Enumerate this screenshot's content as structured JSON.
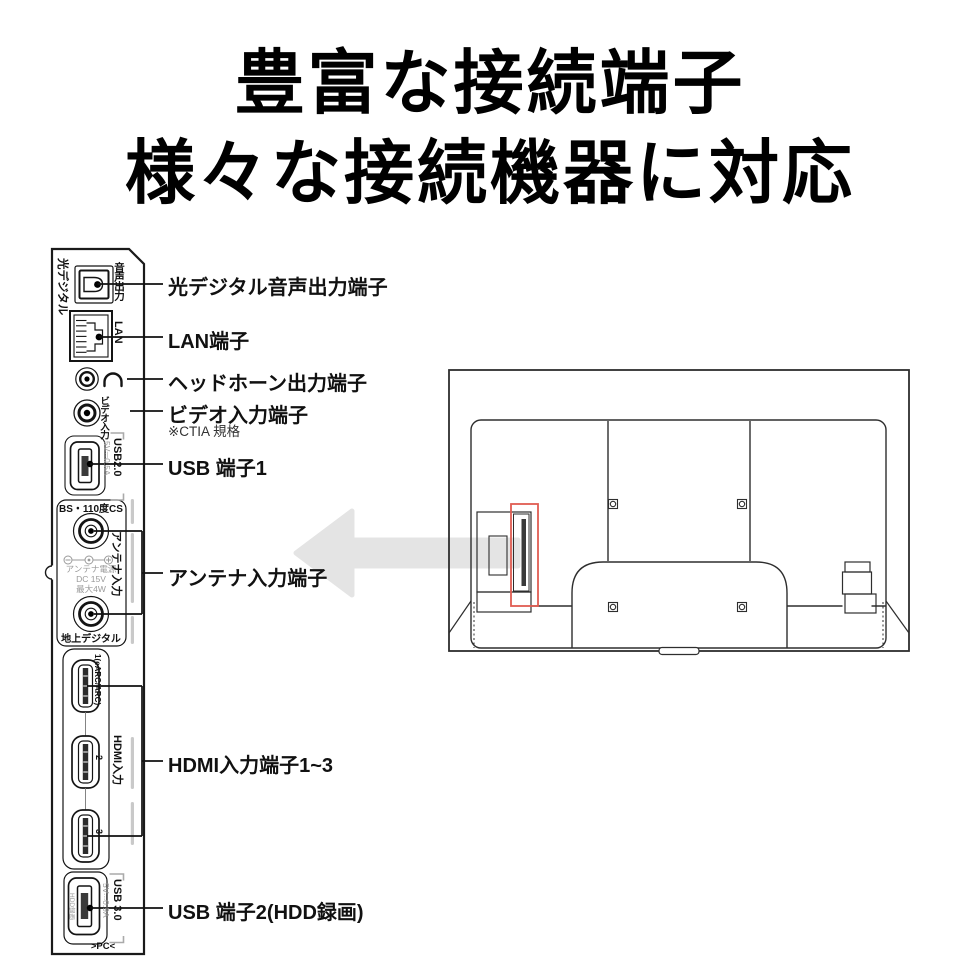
{
  "title": {
    "line1": "豊富な接続端子",
    "line2": "様々な接続機器に対応"
  },
  "panel": {
    "optical_side_label": "光デジタル",
    "optical_port_label": "音声出力",
    "lan_port_label": "LAN",
    "video_port_label": "ビデオ入力",
    "usb1_name_label": "USB2.0",
    "usb1_spec_label": "5V⎓0.5A",
    "antenna_top_label": "BS・110度CS",
    "antenna_power_line1": "アンテナ電源",
    "antenna_power_line2": "DC 15V",
    "antenna_power_line3": "最大4W",
    "antenna_side_label": "アンテナ入力",
    "antenna_bottom_label": "地上デジタル",
    "hdmi1_label": "1(eARC/ARC)",
    "hdmi2_label": "2",
    "hdmi3_label": "3",
    "hdmi_side_label": "HDMI入力",
    "usb2_inner_label": "HDD録画",
    "usb2_spec_label": "5V⎓0.9A",
    "usb2_name_label": "USB 3.0",
    "usb2_bottom_label": ">PC<"
  },
  "callouts": {
    "optical": "光デジタル音声出力端子",
    "lan": "LAN端子",
    "headphone": "ヘッドホーン出力端子",
    "video": "ビデオ入力端子",
    "video_note": "※CTIA 規格",
    "usb1": "USB 端子1",
    "antenna": "アンテナ入力端子",
    "hdmi": "HDMI入力端子1~3",
    "usb2": "USB 端子2(HDD録画)"
  },
  "colors": {
    "line": "#1a1a1a",
    "highlight_red": "#e05c52",
    "arrow_gray": "#e4e4e4",
    "muted_gray": "#9a9a9a"
  }
}
